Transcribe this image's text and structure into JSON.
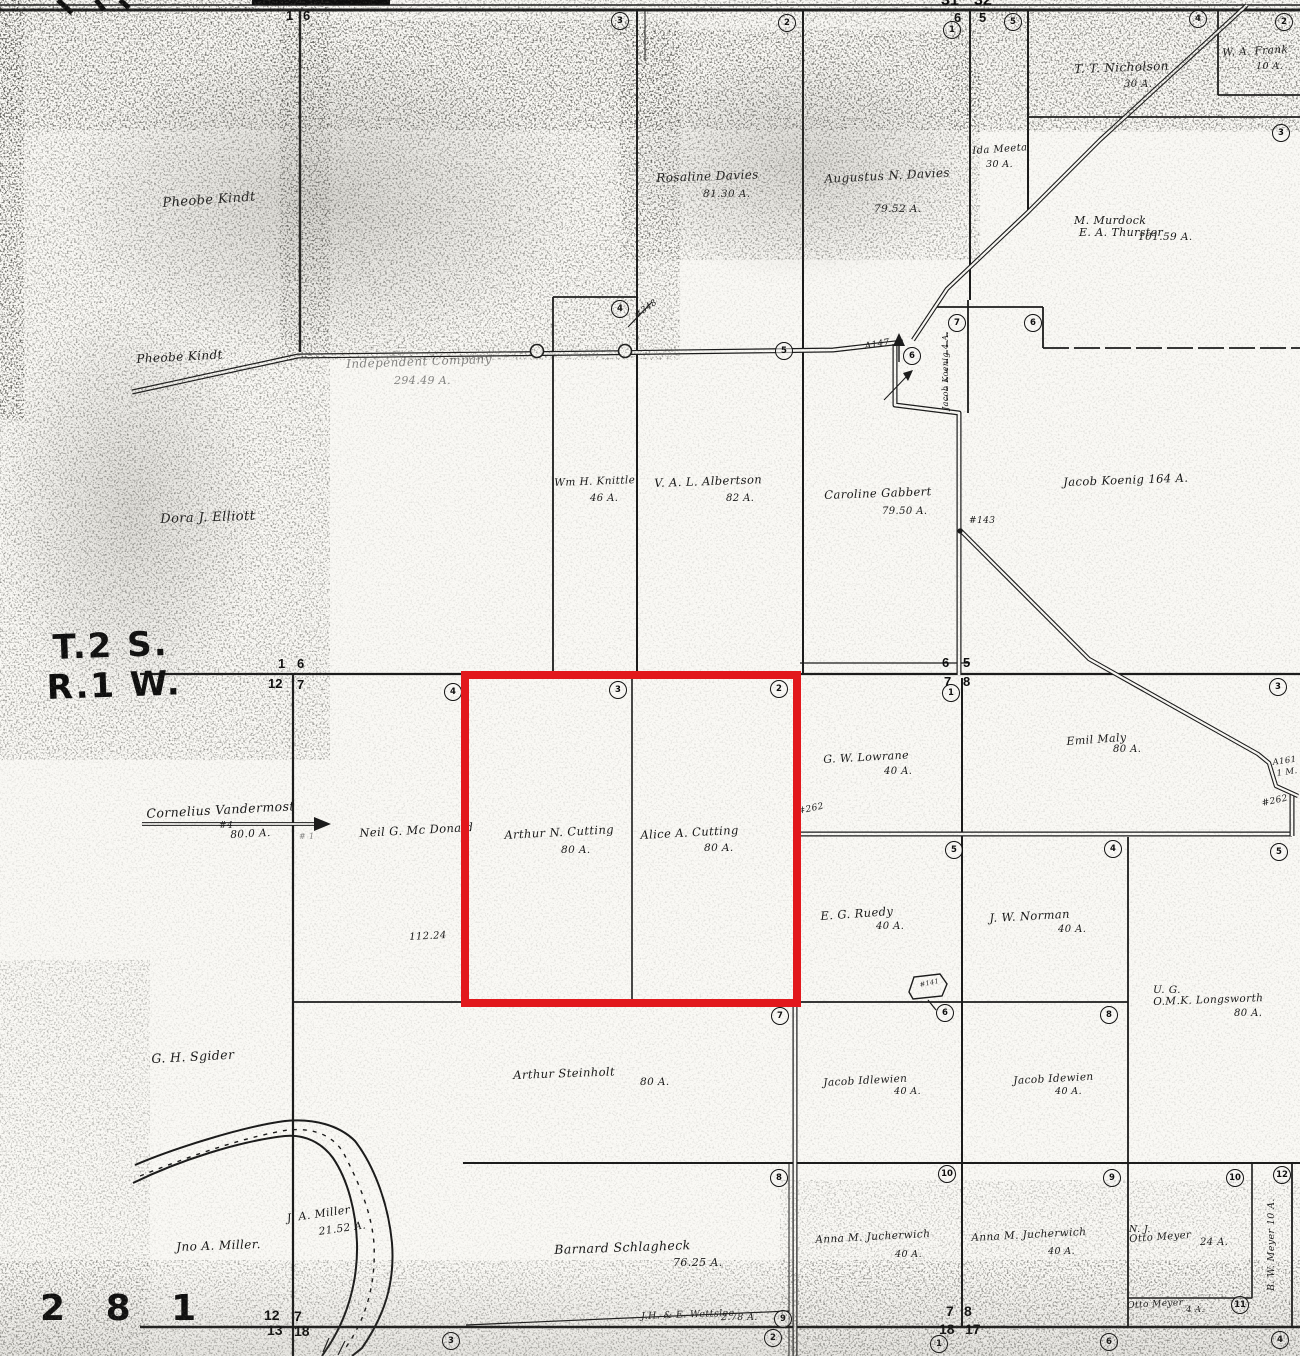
{
  "map": {
    "title": "Plat map township T.2 S. R.1 W. (scanned)",
    "township_label": "T.2 S.",
    "range_label": "R.1 W.",
    "page_number": "2 8 1",
    "highlight": {
      "x": 461,
      "y": 671,
      "w": 340,
      "h": 336,
      "color": "#e2181c",
      "stroke_width": 8
    },
    "labels": [
      {
        "id": "label-pheobe-kindt-upper",
        "text": "Pheobe Kindt",
        "x": 162,
        "y": 196,
        "s": 13,
        "rot": -4
      },
      {
        "id": "label-pheobe-kindt-lower",
        "text": "Pheobe Kindt",
        "x": 136,
        "y": 352,
        "s": 12,
        "rot": -3
      },
      {
        "id": "label-independent-company",
        "text": "Independent Company",
        "x": 346,
        "y": 357,
        "s": 12,
        "rot": -2,
        "cls": "faint"
      },
      {
        "id": "label-independent-company-acres",
        "text": "294.49 A.",
        "x": 394,
        "y": 374,
        "s": 11,
        "cls": "faint"
      },
      {
        "id": "label-rosaline-davies",
        "text": "Rosaline Davies",
        "x": 656,
        "y": 171,
        "s": 12,
        "rot": -2
      },
      {
        "id": "label-rosaline-davies-acres",
        "text": "81.30 A.",
        "x": 703,
        "y": 188,
        "s": 10.5
      },
      {
        "id": "label-augustus-davies",
        "text": "Augustus N. Davies",
        "x": 824,
        "y": 172,
        "s": 12,
        "rot": -3
      },
      {
        "id": "label-augustus-davies-acres",
        "text": "79.52 A.",
        "x": 874,
        "y": 203,
        "s": 10.5
      },
      {
        "id": "label-tt-nicholson",
        "text": "T. T. Nicholson",
        "x": 1074,
        "y": 62,
        "s": 12,
        "rot": -2
      },
      {
        "id": "label-tt-nicholson-acres",
        "text": "30 A.",
        "x": 1124,
        "y": 79,
        "s": 10
      },
      {
        "id": "label-wa-frank",
        "text": "W. A. Frank",
        "x": 1222,
        "y": 47,
        "s": 10.5,
        "rot": -3
      },
      {
        "id": "label-wa-frank-acres",
        "text": "10 A.",
        "x": 1256,
        "y": 61,
        "s": 9.5
      },
      {
        "id": "label-ida-meeta",
        "text": "Ida Meeta",
        "x": 972,
        "y": 146,
        "s": 10,
        "rot": -4
      },
      {
        "id": "label-ida-meeta-acres",
        "text": "30 A.",
        "x": 986,
        "y": 159,
        "s": 9.5
      },
      {
        "id": "label-m-murdock",
        "text": "M. Murdock",
        "x": 1074,
        "y": 214,
        "s": 11
      },
      {
        "id": "label-ea-thurster",
        "text": "E. A. Thurster",
        "x": 1079,
        "y": 226,
        "s": 11
      },
      {
        "id": "label-murdock-acres",
        "text": "101.59 A.",
        "x": 1138,
        "y": 231,
        "s": 10.5
      },
      {
        "id": "label-wm-knittle",
        "text": "Wm H. Knittle",
        "x": 554,
        "y": 477,
        "s": 10.5,
        "rot": -2
      },
      {
        "id": "label-wm-knittle-acres",
        "text": "46 A.",
        "x": 590,
        "y": 493,
        "s": 10
      },
      {
        "id": "label-val-albertson",
        "text": "V. A. L. Albertson",
        "x": 654,
        "y": 476,
        "s": 11.5,
        "rot": -2
      },
      {
        "id": "label-val-albertson-acres",
        "text": "82 A.",
        "x": 726,
        "y": 493,
        "s": 10
      },
      {
        "id": "label-caroline-gabbert",
        "text": "Caroline Gabbert",
        "x": 824,
        "y": 488,
        "s": 11.5,
        "rot": -2
      },
      {
        "id": "label-caroline-gabbert-acres",
        "text": "79.50 A.",
        "x": 882,
        "y": 506,
        "s": 10
      },
      {
        "id": "label-jacob-koenig",
        "text": "Jacob Koenig   164 A.",
        "x": 1063,
        "y": 475,
        "s": 11.5,
        "rot": -2
      },
      {
        "id": "label-dora-elliott",
        "text": "Dora J. Elliott",
        "x": 160,
        "y": 512,
        "s": 13,
        "rot": -2
      },
      {
        "id": "label-cornelius-vandermost",
        "text": "Cornelius Vandermost",
        "x": 146,
        "y": 806,
        "s": 12.5,
        "rot": -3
      },
      {
        "id": "label-vandermost-lot",
        "text": "#4",
        "x": 219,
        "y": 821,
        "s": 9
      },
      {
        "id": "label-vandermost-acres",
        "text": "80.0 A.",
        "x": 230,
        "y": 829,
        "s": 10.5,
        "rot": -3
      },
      {
        "id": "label-hash1",
        "text": "# 1",
        "x": 299,
        "y": 832,
        "s": 8,
        "cls": "faint"
      },
      {
        "id": "label-neil-mcdonald",
        "text": "Neil G. Mc Donald",
        "x": 359,
        "y": 826,
        "s": 11.5,
        "rot": -3
      },
      {
        "id": "label-112-24",
        "text": "112.24",
        "x": 409,
        "y": 932,
        "s": 10,
        "rot": -3
      },
      {
        "id": "label-arthur-cutting",
        "text": "Arthur N. Cutting",
        "x": 504,
        "y": 828,
        "s": 11.5,
        "rot": -3
      },
      {
        "id": "label-arthur-cutting-acres",
        "text": "80 A.",
        "x": 561,
        "y": 844,
        "s": 10.5
      },
      {
        "id": "label-alice-cutting",
        "text": "Alice A. Cutting",
        "x": 640,
        "y": 828,
        "s": 11.5,
        "rot": -3
      },
      {
        "id": "label-alice-cutting-acres",
        "text": "80 A.",
        "x": 704,
        "y": 842,
        "s": 10.5
      },
      {
        "id": "label-gw-lowrane",
        "text": "G. W. Lowrane",
        "x": 823,
        "y": 753,
        "s": 11,
        "rot": -3
      },
      {
        "id": "label-gw-lowrane-acres",
        "text": "40 A.",
        "x": 884,
        "y": 766,
        "s": 10
      },
      {
        "id": "label-emil-maly",
        "text": "Emil Maly",
        "x": 1066,
        "y": 735,
        "s": 11,
        "rot": -4
      },
      {
        "id": "label-emil-maly-acres",
        "text": "80 A.",
        "x": 1113,
        "y": 744,
        "s": 10
      },
      {
        "id": "label-eg-ruedy",
        "text": "E. G. Ruedy",
        "x": 820,
        "y": 909,
        "s": 11.5,
        "rot": -4
      },
      {
        "id": "label-eg-ruedy-acres",
        "text": "40 A.",
        "x": 876,
        "y": 921,
        "s": 10
      },
      {
        "id": "label-jw-norman",
        "text": "J. W. Norman",
        "x": 989,
        "y": 911,
        "s": 11.5,
        "rot": -3
      },
      {
        "id": "label-jw-norman-acres",
        "text": "40 A.",
        "x": 1058,
        "y": 924,
        "s": 10
      },
      {
        "id": "label-ug",
        "text": "U. G.",
        "x": 1153,
        "y": 984,
        "s": 10.5
      },
      {
        "id": "label-omk-longsworth",
        "text": "O.M.K. Longsworth",
        "x": 1153,
        "y": 996,
        "s": 10.5,
        "rot": -2
      },
      {
        "id": "label-longsworth-acres",
        "text": "80 A.",
        "x": 1234,
        "y": 1008,
        "s": 10
      },
      {
        "id": "label-gh-sgider",
        "text": "G. H. Sgider",
        "x": 151,
        "y": 1051,
        "s": 12.5,
        "rot": -3
      },
      {
        "id": "label-arthur-steinholt",
        "text": "Arthur Steinholt",
        "x": 513,
        "y": 1068,
        "s": 11.5,
        "rot": -2
      },
      {
        "id": "label-steinholt-acres",
        "text": "80 A.",
        "x": 640,
        "y": 1076,
        "s": 10.5
      },
      {
        "id": "label-jacob-idlewien",
        "text": "Jacob Idlewien",
        "x": 823,
        "y": 1077,
        "s": 10.5,
        "rot": -3
      },
      {
        "id": "label-jacob-idlewien-acres",
        "text": "40 A.",
        "x": 894,
        "y": 1086,
        "s": 9.5
      },
      {
        "id": "label-jacob-idewien",
        "text": "Jacob Idewien",
        "x": 1013,
        "y": 1075,
        "s": 10.5,
        "rot": -3
      },
      {
        "id": "label-jacob-idewien-acres",
        "text": "40 A.",
        "x": 1055,
        "y": 1086,
        "s": 9.5
      },
      {
        "id": "label-jno-miller",
        "text": "Jno A. Miller.",
        "x": 176,
        "y": 1240,
        "s": 12,
        "rot": -2
      },
      {
        "id": "label-ja-miller",
        "text": "J. A. Miller",
        "x": 286,
        "y": 1212,
        "s": 11,
        "rot": -8
      },
      {
        "id": "label-ja-miller-acres",
        "text": "21.52 A.",
        "x": 318,
        "y": 1226,
        "s": 10.5,
        "rot": -8
      },
      {
        "id": "label-barnard-schlagheck",
        "text": "Barnard  Schlagheck",
        "x": 554,
        "y": 1242,
        "s": 12.5,
        "rot": -2
      },
      {
        "id": "label-schlagheck-acres",
        "text": "76.25 A.",
        "x": 673,
        "y": 1256,
        "s": 11
      },
      {
        "id": "label-anna-jucherwich-1",
        "text": "Anna M. Jucherwich",
        "x": 815,
        "y": 1234,
        "s": 10.5,
        "rot": -3
      },
      {
        "id": "label-anna-jucherwich-1-acres",
        "text": "40 A.",
        "x": 895,
        "y": 1249,
        "s": 9.5
      },
      {
        "id": "label-anna-jucherwich-2",
        "text": "Anna M. Jucherwich",
        "x": 971,
        "y": 1232,
        "s": 10.5,
        "rot": -3
      },
      {
        "id": "label-anna-jucherwich-2-acres",
        "text": "40 A.",
        "x": 1048,
        "y": 1246,
        "s": 9.5
      },
      {
        "id": "label-nj",
        "text": "N. J.",
        "x": 1129,
        "y": 1224,
        "s": 9.5
      },
      {
        "id": "label-nj-otto-meyer",
        "text": "Otto Meyer",
        "x": 1129,
        "y": 1234,
        "s": 10,
        "rot": -4
      },
      {
        "id": "label-nj-otto-meyer-acres",
        "text": "24 A.",
        "x": 1200,
        "y": 1237,
        "s": 10
      },
      {
        "id": "label-otto-meyer-small",
        "text": "Otto Meyer",
        "x": 1127,
        "y": 1301,
        "s": 9,
        "rot": -3
      },
      {
        "id": "label-otto-meyer-small-acres",
        "text": "4 A.",
        "x": 1186,
        "y": 1305,
        "s": 8.5
      },
      {
        "id": "label-bw-meyer",
        "text": "B. W. Meyer    10 A.",
        "x": 1266,
        "y": 1291,
        "s": 9.5,
        "cls": "vert"
      },
      {
        "id": "label-wettslee",
        "text": "J.H. & E. Wettslee",
        "x": 641,
        "y": 1311,
        "s": 9.5,
        "rot": -2
      },
      {
        "id": "label-wettslee-acres",
        "text": "2.78 A.",
        "x": 721,
        "y": 1312,
        "s": 9.5
      },
      {
        "id": "label-road-a147",
        "text": "A147",
        "x": 864,
        "y": 342,
        "s": 9,
        "rot": -10
      },
      {
        "id": "label-road-143",
        "text": "#143",
        "x": 969,
        "y": 516,
        "s": 9
      },
      {
        "id": "label-road-141",
        "text": "#141",
        "x": 919,
        "y": 981,
        "s": 6.5,
        "rot": -12
      },
      {
        "id": "label-road-262-west",
        "text": "#262",
        "x": 797,
        "y": 807,
        "s": 9,
        "rot": -12
      },
      {
        "id": "label-road-262-east",
        "text": "#262",
        "x": 1261,
        "y": 799,
        "s": 9,
        "rot": -12
      },
      {
        "id": "label-road-a161",
        "text": "A161",
        "x": 1272,
        "y": 758,
        "s": 8.5,
        "rot": -8
      },
      {
        "id": "label-road-a161-m",
        "text": "1 M.",
        "x": 1276,
        "y": 769,
        "s": 8.5,
        "rot": -8
      },
      {
        "id": "label-jacob-koenig-4a",
        "text": "Jacob Koenig  4 A.",
        "x": 941,
        "y": 410,
        "s": 8,
        "cls": "vert"
      },
      {
        "id": "label-road-348",
        "text": "#348",
        "x": 633,
        "y": 312,
        "s": 8.5,
        "rot": -35
      }
    ],
    "big_labels": [
      {
        "id": "township-label",
        "text": "T.2 S.",
        "x": 52,
        "y": 628,
        "s": 34,
        "rot": -2
      },
      {
        "id": "range-label",
        "text": "R.1 W.",
        "x": 46,
        "y": 668,
        "s": 34,
        "rot": -2
      },
      {
        "id": "page-number",
        "text": "2 8 1",
        "x": 40,
        "y": 1288,
        "s": 36,
        "rot": 0
      }
    ],
    "corner_numbers": [
      {
        "t": "31",
        "x": 941,
        "y": -7,
        "s": 16
      },
      {
        "t": "32",
        "x": 974,
        "y": -7,
        "s": 16
      },
      {
        "t": "6",
        "x": 954,
        "y": 11,
        "s": 13
      },
      {
        "t": "5",
        "x": 979,
        "y": 11,
        "s": 13
      },
      {
        "t": "1",
        "x": 286,
        "y": 9,
        "s": 13
      },
      {
        "t": "6",
        "x": 303,
        "y": 9,
        "s": 13
      },
      {
        "t": "1",
        "x": 278,
        "y": 657,
        "s": 13
      },
      {
        "t": "6",
        "x": 297,
        "y": 657,
        "s": 13
      },
      {
        "t": "12",
        "x": 268,
        "y": 677,
        "s": 13
      },
      {
        "t": "7",
        "x": 297,
        "y": 678,
        "s": 13
      },
      {
        "t": "6",
        "x": 942,
        "y": 656,
        "s": 13
      },
      {
        "t": "5",
        "x": 963,
        "y": 656,
        "s": 13
      },
      {
        "t": "7",
        "x": 944,
        "y": 675,
        "s": 13
      },
      {
        "t": "8",
        "x": 963,
        "y": 675,
        "s": 13
      },
      {
        "t": "12",
        "x": 264,
        "y": 1308,
        "s": 14
      },
      {
        "t": "7",
        "x": 294,
        "y": 1309,
        "s": 14
      },
      {
        "t": "13",
        "x": 267,
        "y": 1323,
        "s": 14
      },
      {
        "t": "18",
        "x": 294,
        "y": 1324,
        "s": 14
      },
      {
        "t": "7",
        "x": 946,
        "y": 1304,
        "s": 14
      },
      {
        "t": "8",
        "x": 964,
        "y": 1304,
        "s": 14
      },
      {
        "t": "18",
        "x": 939,
        "y": 1322,
        "s": 14
      },
      {
        "t": "17",
        "x": 965,
        "y": 1322,
        "s": 14
      }
    ],
    "lot_markers": [
      {
        "n": "3",
        "x": 620,
        "y": 21
      },
      {
        "n": "2",
        "x": 787,
        "y": 23
      },
      {
        "n": "1",
        "x": 952,
        "y": 30
      },
      {
        "n": "5",
        "x": 1013,
        "y": 22
      },
      {
        "n": "4",
        "x": 1198,
        "y": 19
      },
      {
        "n": "2",
        "x": 1284,
        "y": 22
      },
      {
        "n": "3",
        "x": 1281,
        "y": 133
      },
      {
        "n": "4",
        "x": 620,
        "y": 309
      },
      {
        "n": "5",
        "x": 784,
        "y": 351
      },
      {
        "n": "6",
        "x": 912,
        "y": 356
      },
      {
        "n": "7",
        "x": 957,
        "y": 323
      },
      {
        "n": "6",
        "x": 1033,
        "y": 323
      },
      {
        "n": "4",
        "x": 453,
        "y": 692
      },
      {
        "n": "3",
        "x": 618,
        "y": 690
      },
      {
        "n": "2",
        "x": 779,
        "y": 689
      },
      {
        "n": "1",
        "x": 951,
        "y": 693
      },
      {
        "n": "3",
        "x": 1278,
        "y": 687
      },
      {
        "n": "5",
        "x": 954,
        "y": 850
      },
      {
        "n": "4",
        "x": 1113,
        "y": 849
      },
      {
        "n": "5",
        "x": 1279,
        "y": 852
      },
      {
        "n": "7",
        "x": 780,
        "y": 1016
      },
      {
        "n": "6",
        "x": 945,
        "y": 1013
      },
      {
        "n": "8",
        "x": 1109,
        "y": 1015
      },
      {
        "n": "8",
        "x": 779,
        "y": 1178
      },
      {
        "n": "10",
        "x": 947,
        "y": 1174
      },
      {
        "n": "9",
        "x": 1112,
        "y": 1178
      },
      {
        "n": "10",
        "x": 1235,
        "y": 1178
      },
      {
        "n": "12",
        "x": 1282,
        "y": 1175
      },
      {
        "n": "11",
        "x": 1240,
        "y": 1305
      },
      {
        "n": "3",
        "x": 451,
        "y": 1341
      },
      {
        "n": "9",
        "x": 783,
        "y": 1319
      },
      {
        "n": "2",
        "x": 773,
        "y": 1338
      },
      {
        "n": "1",
        "x": 939,
        "y": 1344
      },
      {
        "n": "6",
        "x": 1109,
        "y": 1342
      },
      {
        "n": "4",
        "x": 1280,
        "y": 1340
      }
    ]
  }
}
